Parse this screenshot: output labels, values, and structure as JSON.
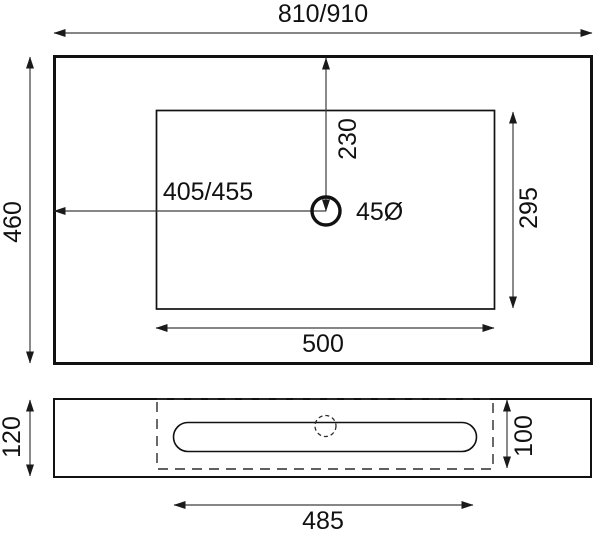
{
  "top_view": {
    "overall_width": "810/910",
    "overall_depth": "460",
    "drain_offset_left": "405/455",
    "drain_offset_front": "230",
    "drain_diameter": "45Ø",
    "basin_width": "500",
    "basin_depth": "295"
  },
  "front_view": {
    "panel_height": "120",
    "recess_height": "100",
    "slot_width": "485"
  },
  "colors": {
    "outline": "#111111",
    "dimension_line": "#3d3d3d",
    "background": "#ffffff"
  }
}
